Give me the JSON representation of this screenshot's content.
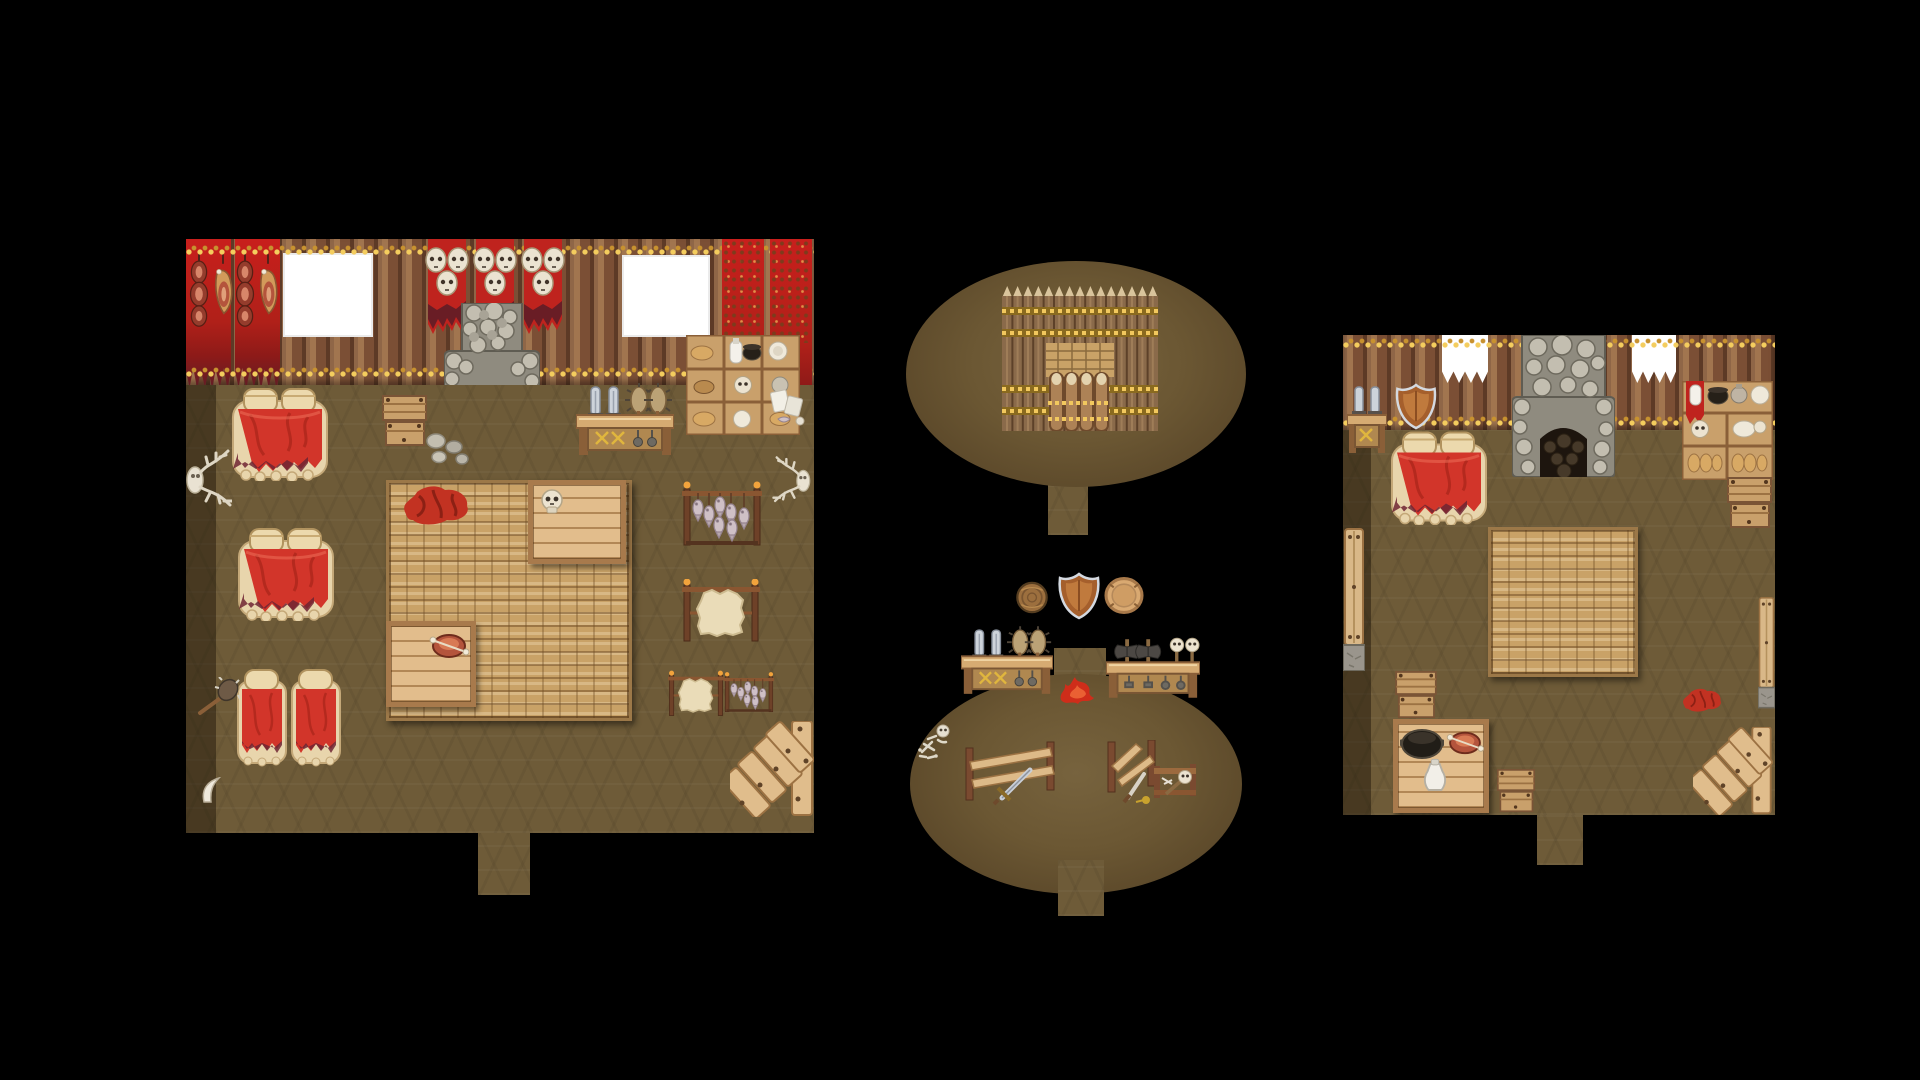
{
  "app": {
    "name": "rpg-tilemap-screenshot",
    "description": "Top-down pixel-art tilemap with three barbarian-style interior maps on a black canvas"
  },
  "colors": {
    "background": "#000000",
    "floor": "#6e5b38",
    "floor_shadow": "#4a3b24",
    "wall_log_mid": "#7d5138",
    "garland_gold": "#f4cd5e",
    "garland_dark": "#c8922f",
    "banner_red": "#bf231e",
    "skull_bone": "#ece3d0",
    "stone_mid": "#8f8b7f",
    "hearth_black": "#1d150e",
    "rug_light": "#c9a267",
    "wood_light": "#e2bd8c",
    "blanket_red": "#d2352a",
    "fur_tan": "#e8d5ac",
    "metal_silver": "#cdd3da",
    "fire_red": "#cf2d1a",
    "shield_copper": "#b06a33",
    "window_white": "#ffffff"
  },
  "panels": [
    {
      "id": "great-hall",
      "label": "Great hall interior map",
      "objects": [
        "meat-curtain",
        "window",
        "skull-banners",
        "stone-fireplace",
        "window",
        "patterned-curtains",
        "wall-shelf",
        "deer-skull-trophy",
        "double-bed",
        "double-bed",
        "single-bed",
        "single-bed",
        "spiked-club",
        "drinking-horn",
        "wooden-crate",
        "stones",
        "woven-rug",
        "red-cloth",
        "table-with-skull",
        "table-with-roast",
        "weapon-counter",
        "paper-and-fish",
        "fish-drying-rack",
        "hide-drying-rack",
        "hide-and-fish-rack",
        "antler-trophy",
        "plank-stairs",
        "door-gap"
      ]
    },
    {
      "id": "palisade-yard",
      "label": "Oval yard with spiked palisade and gate",
      "objects": [
        "spiked-palisade",
        "woven-mat",
        "gate-logs",
        "south-path"
      ]
    },
    {
      "id": "weapon-yard",
      "label": "Oval yard with weapon stalls",
      "objects": [
        "round-wooden-shield",
        "copper-heater-shield",
        "tan-round-shield",
        "sword-counter",
        "axe-counter",
        "campfire",
        "skeleton-remains",
        "toppled-bench-with-sword",
        "toppled-bench-with-dagger",
        "skull-mace-rack",
        "north-path",
        "south-path"
      ]
    },
    {
      "id": "small-hut",
      "label": "Small hut interior map",
      "objects": [
        "sword-rack",
        "copper-heater-shield",
        "double-bed",
        "stone-fireplace",
        "window",
        "window",
        "supply-shelf",
        "crate-stack",
        "wall-bench",
        "woven-rug",
        "small-crate",
        "kitchen-table",
        "cauldron",
        "roast-meat",
        "jug",
        "drawer-chest",
        "red-cloth",
        "wall-bench",
        "plank-stairs",
        "door-gap"
      ]
    }
  ]
}
